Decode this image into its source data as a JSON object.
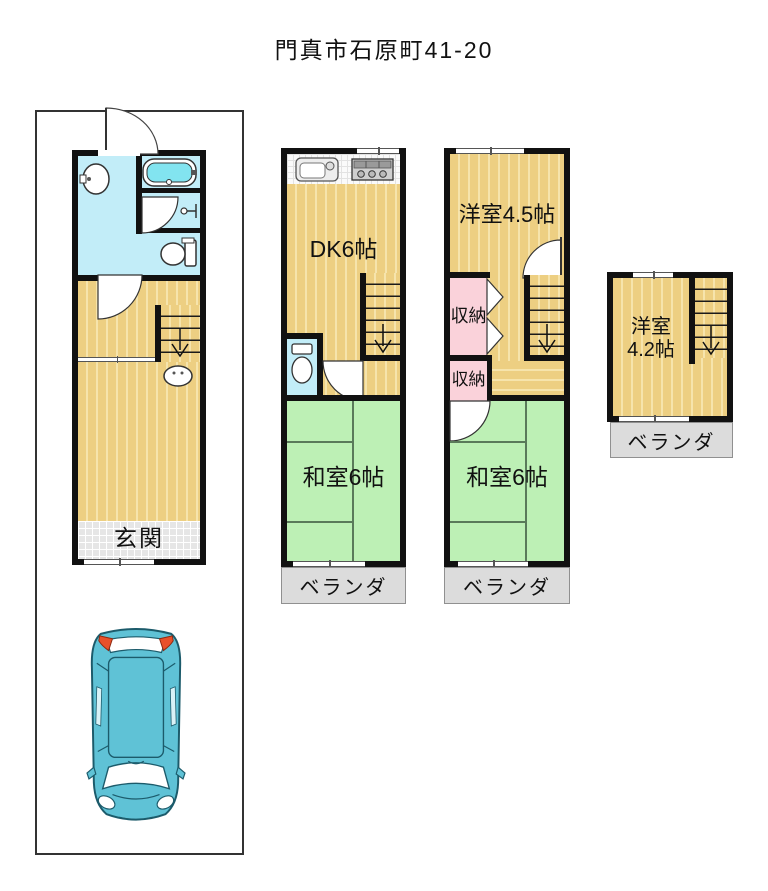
{
  "title": "門真市石原町41-20",
  "floor1": {
    "entrance": "玄関"
  },
  "floor2": {
    "dk": "DK6帖",
    "tatami": "和室6帖",
    "balcony": "ベランダ"
  },
  "floor3": {
    "western": "洋室4.5帖",
    "closet_upper": "収納",
    "closet_lower": "収納",
    "tatami": "和室6帖",
    "balcony": "ベランダ"
  },
  "floor4": {
    "western_line1": "洋室",
    "western_line2": "4.2帖",
    "balcony": "ベランダ"
  },
  "colors": {
    "wall": "#111111",
    "floor_tan": "#edcf82",
    "floor_stripe": "#f6e4ac",
    "tatami_green": "#bdf0b5",
    "water_cyan": "#c2edf8",
    "bathtub_cyan": "#82e4f0",
    "closet_pink": "#fad2da",
    "balcony_gray": "#dcdcdc",
    "entrance_tile": "#e6e6e6",
    "car_teal": "#5fc2d6",
    "car_light_red": "#e8502a"
  }
}
